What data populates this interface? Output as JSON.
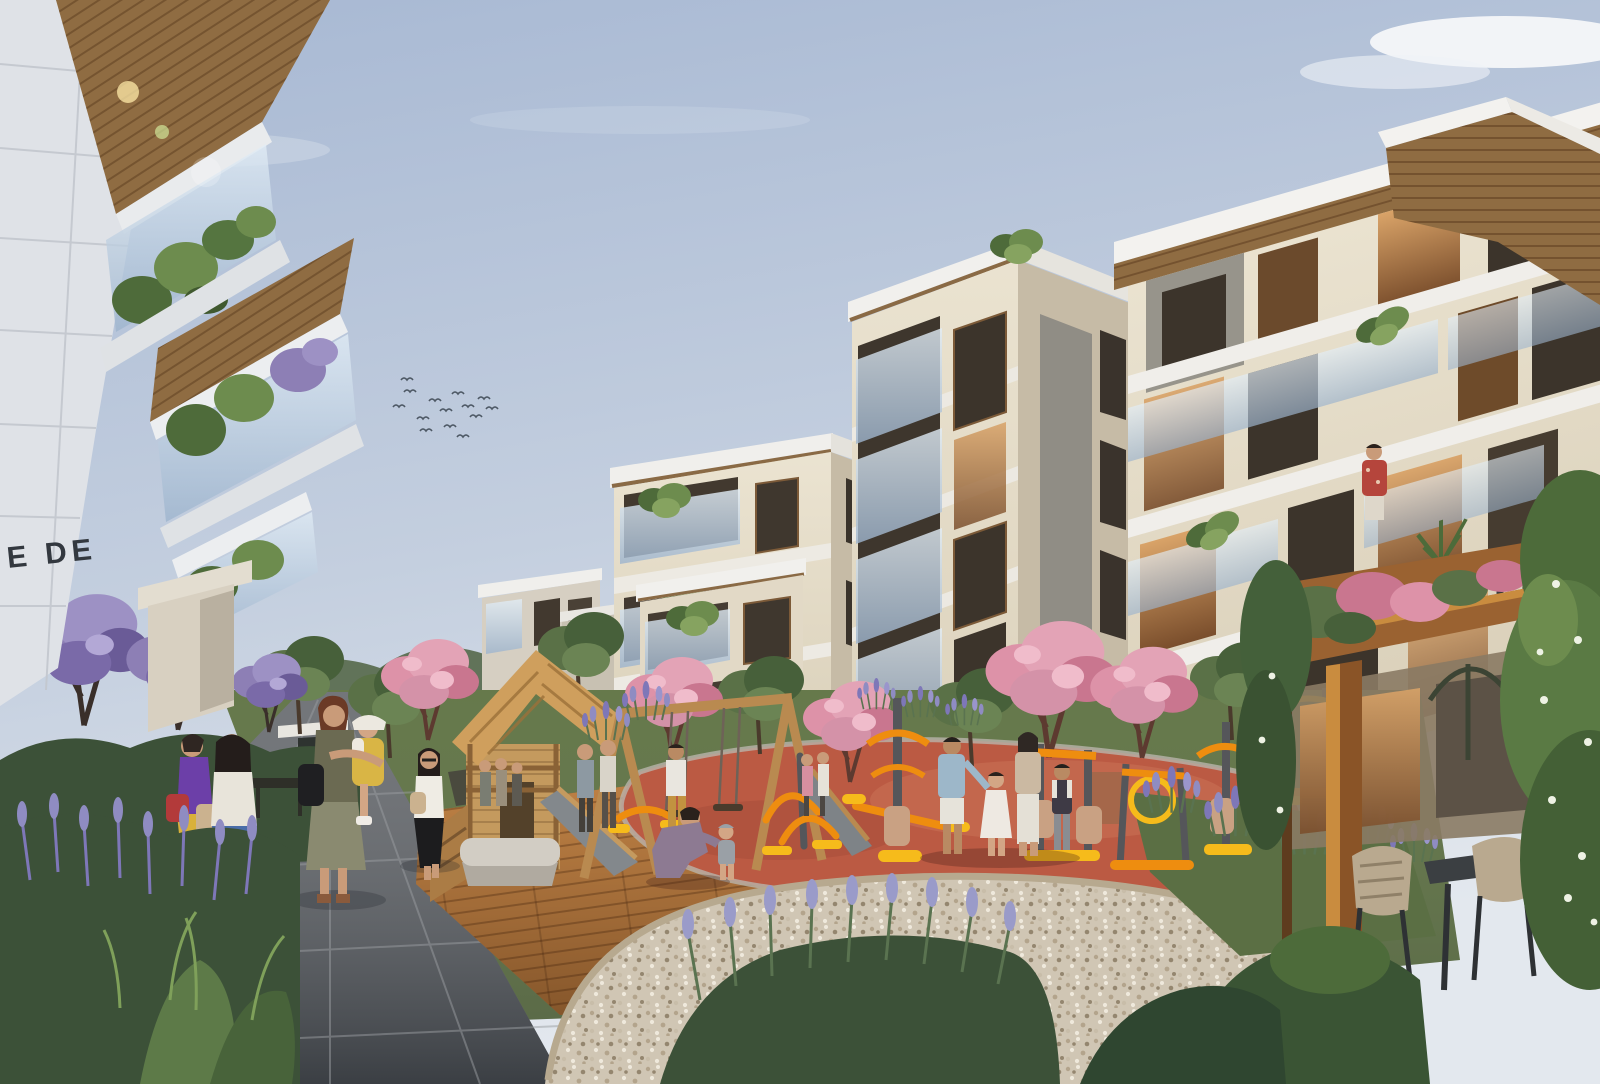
{
  "scene": {
    "type": "architectural-rendering",
    "setting": "residential complex courtyard with playground and fitness area",
    "time_of_day": "day",
    "signage_text": "E DE",
    "birds_count": 14
  },
  "palette": {
    "sky_top": "#a7b8d3",
    "sky_mid": "#c4cfdf",
    "sky_horizon": "#e3e8ee",
    "cloud_white": "#f5f7f9",
    "facade_white": "#dfe2e7",
    "facade_cream": "#e7dfcc",
    "facade_cream_shade": "#c6bba6",
    "wood_soffit": "#8f6c42",
    "wood_play": "#c49a5e",
    "pergola_wood": "#9a6231",
    "glass_blue": "#aac1d8",
    "window_dark": "#42392f",
    "window_warm": "#c08b57",
    "foliage_green": "#5a7147",
    "foliage_dark": "#3c5138",
    "blossom_pink": "#dd92a8",
    "blossom_purple": "#8d7fb5",
    "lavender_purple": "#8f8cc2",
    "lawn_green": "#66794b",
    "path_grey": "#73767a",
    "deck_wood": "#b5763d",
    "gravel_beige": "#d0c6b4",
    "playground_red": "#bb5a43",
    "equipment_orange": "#ee8d0f",
    "equipment_yellow": "#f6bb1b",
    "bench_stone": "#d2cdc4",
    "sign_dark": "#33383f"
  },
  "elements": {
    "buildings": [
      "left low-rise with planted glass balconies",
      "center cream apartment block",
      "right mid-rise with stone core",
      "right front block with overhanging timber-soffit roofs"
    ],
    "landscape": [
      "purple blossom trees",
      "pink blossom trees",
      "lavender beds",
      "ornamental grasses",
      "gravel bed",
      "timber deck",
      "stone paver walkway"
    ],
    "play_area": [
      "timber playhouse with slide",
      "timber swing set",
      "red rubber safety surface",
      "orange outdoor fitness equipment",
      "stone bench"
    ],
    "amenities": [
      "timber pergola with climbing vines",
      "outdoor table with woven chairs"
    ],
    "people": [
      "two women chatting on path",
      "mother carrying child",
      "woman walking in black skirt",
      "family of four on red surface",
      "father kneeling with toddler",
      "resident on balcony",
      "children near fitness equipment"
    ]
  }
}
